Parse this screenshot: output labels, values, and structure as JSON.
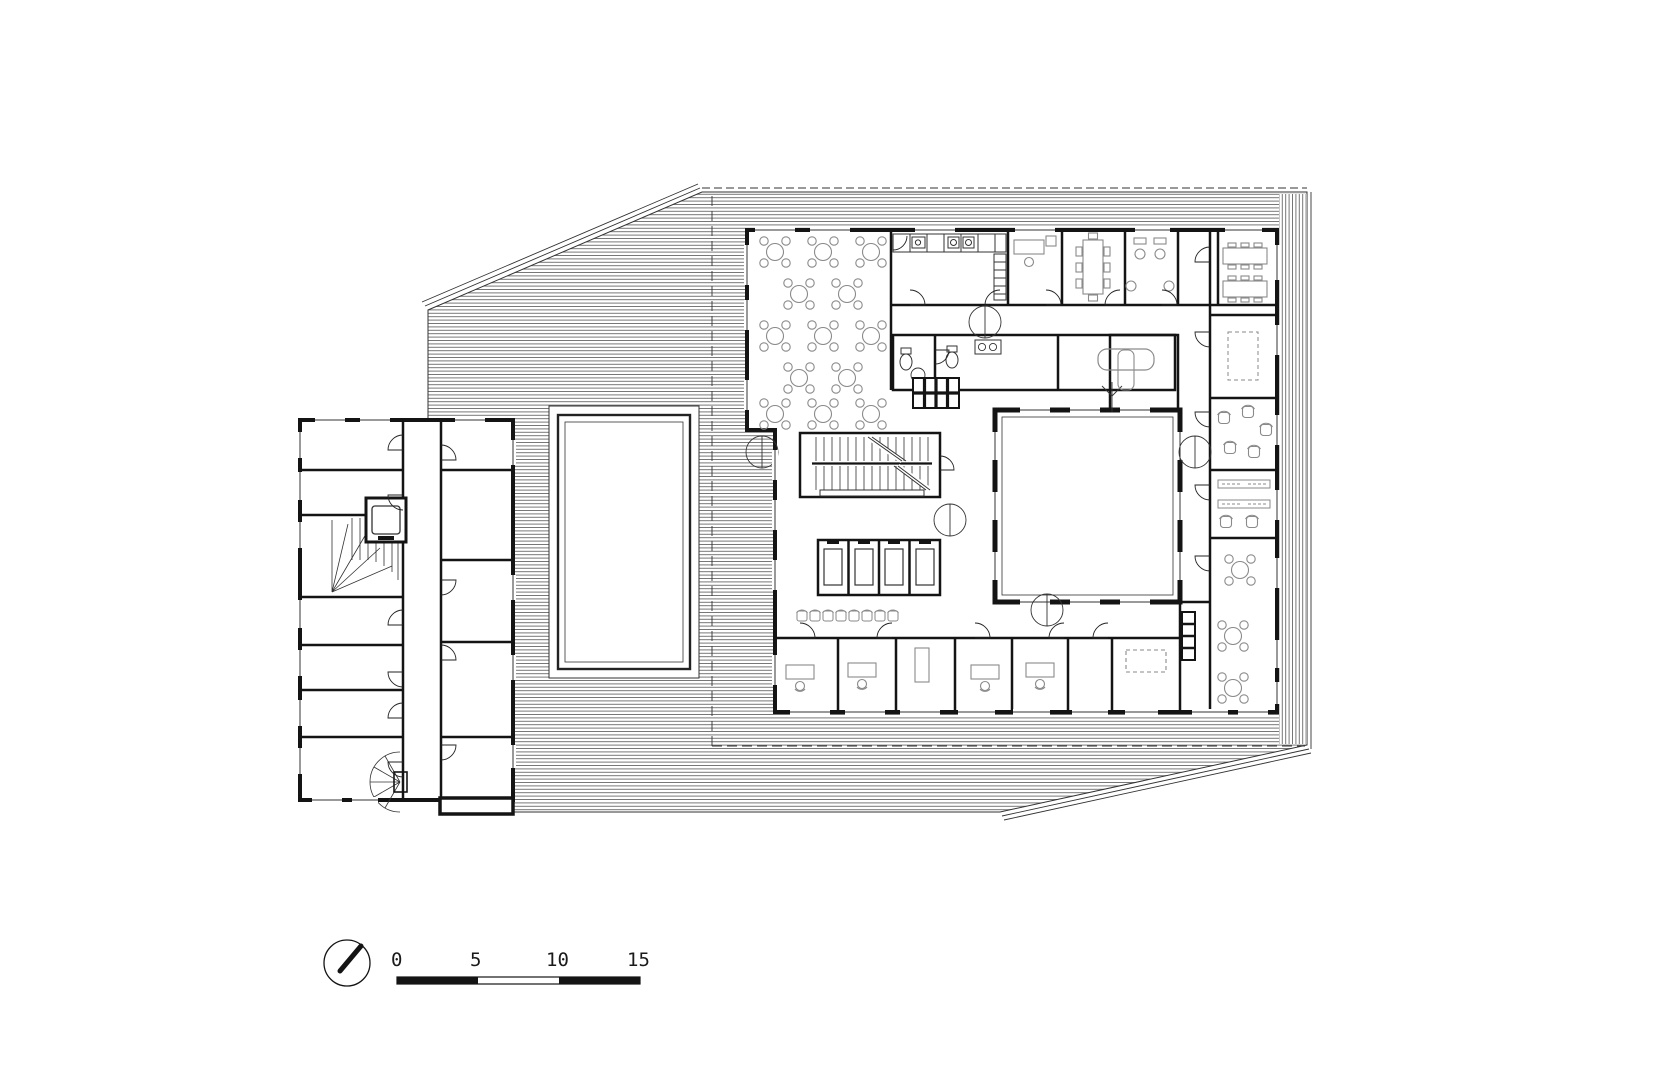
{
  "drawing": {
    "scale_bar": {
      "labels": [
        "0",
        "5",
        "10",
        "15"
      ]
    },
    "icons": {
      "north_arrow": "north-arrow-icon"
    },
    "colors": {
      "wall": "#141414",
      "thin_line": "#333333",
      "furniture": "#8a8a8a",
      "hatch_line": "#565656",
      "background": "#ffffff"
    }
  }
}
